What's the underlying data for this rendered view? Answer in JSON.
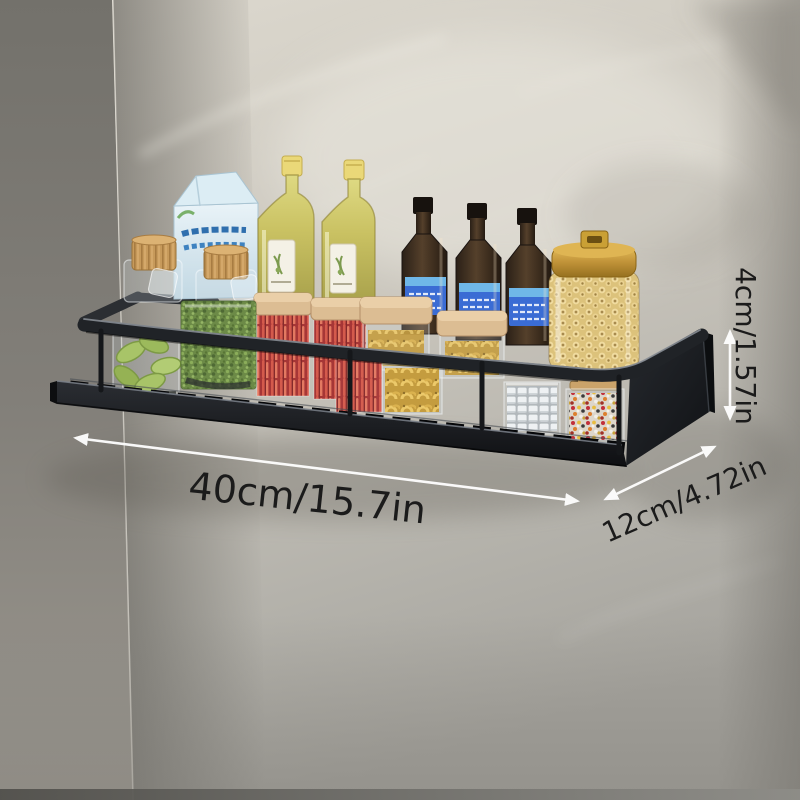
{
  "product": {
    "name": "wall-mounted-spice-rack-shelf",
    "scene": "Black metal kitchen spice rack shelf mounted near a gray marble wall corner, holding condiment jars and bottles, with dimension callouts"
  },
  "annotations": {
    "width_label": "40cm/15.7in",
    "depth_label": "12cm/4.72in",
    "height_label": "4cm/1.57in"
  },
  "colors": {
    "label_text": "#1b1b1b",
    "arrow": "#ffffff",
    "shelf": "#17191c",
    "shelf_highlight": "#858b92",
    "gold": "#c79a33",
    "lid_tan": "#dcbd93",
    "chili_red": "#c03030",
    "pasta_yellow": "#e3bc55",
    "herb_green": "#64883a",
    "edamame_green": "#a3bf62",
    "cork_tan": "#c79a5b",
    "carton_blue": "#dcebf3",
    "sauce_label_blue": "#3a6cd4",
    "olive_oil": "#c9c162",
    "wall_light": "#cdc9c0",
    "wall_dark": "#8d8a83"
  },
  "items": [
    "glass jars with cork lids",
    "light blue carton",
    "olive oil bottles",
    "dark sauce bottles with blue labels",
    "glass canister with gold lid filled with macaroni",
    "square spice jars with wooden lids (chili sticks, pasta)",
    "jar of edamame pods",
    "jar of green herbs",
    "jar of sugar cubes",
    "jar of colorful sprinkles"
  ]
}
